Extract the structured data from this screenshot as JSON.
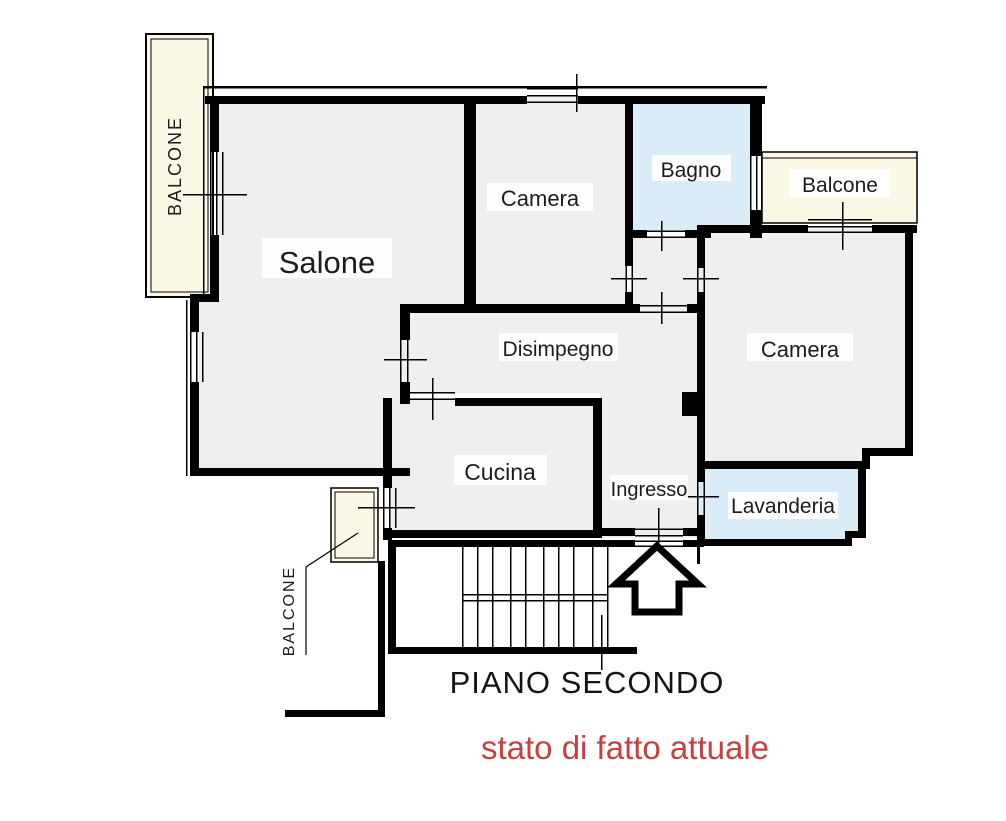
{
  "plan": {
    "rooms": {
      "salone": "Salone",
      "camera_top": "Camera",
      "bagno": "Bagno",
      "camera_right": "Camera",
      "disimpegno": "Disimpegno",
      "cucina": "Cucina",
      "ingresso": "Ingresso",
      "lavanderia": "Lavanderia"
    },
    "balconies": {
      "top_left": "BALCONE",
      "top_right": "Balcone",
      "bottom": "BALCONE"
    },
    "captions": {
      "floor_title": "PIANO SECONDO",
      "status_note": "stato di fatto attuale"
    },
    "colors": {
      "room_fill": "#efefef",
      "wet_room_fill": "#d9ecf8",
      "balcony_fill": "#fbf9e6",
      "wall": "#000000",
      "floor_title_text": "#141414",
      "status_note_text": "#c5403e"
    }
  }
}
